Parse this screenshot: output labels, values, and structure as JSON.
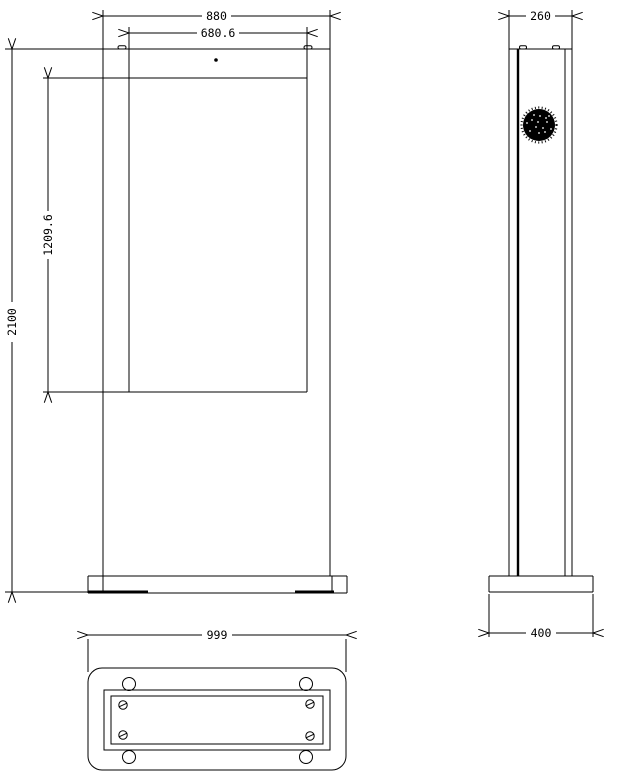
{
  "colors": {
    "background": "#ffffff",
    "line": "#000000",
    "text": "#000000"
  },
  "views": {
    "front": {
      "dims": {
        "overall_width": "880",
        "display_width": "680.6",
        "overall_height": "2100",
        "display_height": "1209.6"
      }
    },
    "side": {
      "dims": {
        "depth": "260",
        "base_depth": "400"
      }
    },
    "bottom": {
      "dims": {
        "base_width": "999"
      }
    }
  },
  "icons": {
    "fan_grille": "stippled-circle",
    "camera": "dot",
    "screw": "circle-with-slash",
    "bolt_hole": "circle"
  }
}
